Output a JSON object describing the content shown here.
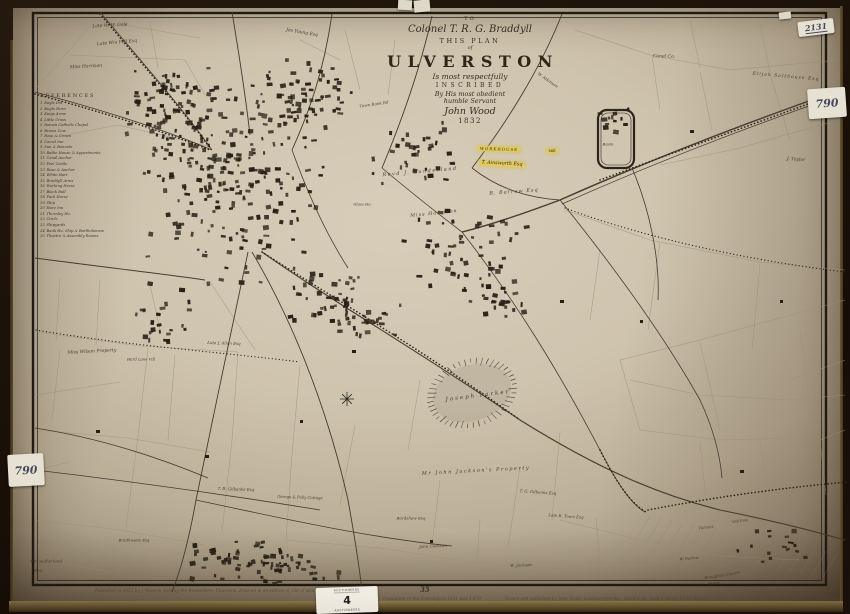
{
  "cartouche": {
    "to": "TO",
    "dedicatee": "Colonel T. R. G. Braddyll",
    "this_plan": "THIS PLAN",
    "of": "of",
    "town": "ULVERSTON",
    "respect_line": "Is most respectfully",
    "inscribed": "INSCRIBED",
    "obedient_line": "By His most obedient",
    "humble_line": "humble Servant",
    "signature": "John Wood",
    "year": "1832"
  },
  "references": {
    "heading": "REFERENCES",
    "items": [
      "Eagle Inn",
      "Bugle Horn",
      "Kings Arms",
      "Little Cross",
      "Roman Catholic Chapel",
      "Brown Cow",
      "Rose & Crown",
      "Camel Inn",
      "Sun & Bonnets",
      "Bathe House & Appartments",
      "Canal Anchor",
      "Peel Castle",
      "Rose & Anchor",
      "White Hart",
      "Braddyll Arms",
      "Working Horse",
      "Black Bull",
      "Pack Horse",
      "Ship",
      "Hare Inn",
      "Thornley Ho.",
      "Circle",
      "Shipyards",
      "Bank Ho. Ship & Bartholomew",
      "Theatre & Assembly Rooms"
    ]
  },
  "map_labels": [
    {
      "t": "Late W. W. Gale",
      "x": 110,
      "y": 26,
      "r": -3,
      "s": 4.5,
      "it": true
    },
    {
      "t": "Late Wm Fell Esq",
      "x": 117,
      "y": 43,
      "r": -5,
      "s": 4.5,
      "it": true
    },
    {
      "t": "Miss Harrison",
      "x": 86,
      "y": 67,
      "r": -3,
      "s": 4.5,
      "it": true
    },
    {
      "t": "Jas Young Esq",
      "x": 302,
      "y": 33,
      "r": 10,
      "s": 4.5,
      "it": true
    },
    {
      "t": "W. Atkinson",
      "x": 548,
      "y": 80,
      "r": 35,
      "s": 4,
      "it": true
    },
    {
      "t": "Town Bank Rd",
      "x": 374,
      "y": 104,
      "r": -8,
      "s": 4,
      "it": true
    },
    {
      "t": "Canal Co.",
      "x": 664,
      "y": 57,
      "r": 2,
      "s": 4.5,
      "it": true
    },
    {
      "t": "Elijah Salthouse Esq",
      "x": 786,
      "y": 77,
      "r": 5,
      "s": 4.5,
      "it": true,
      "sp": 1
    },
    {
      "t": "Basin",
      "x": 608,
      "y": 144,
      "r": 0,
      "s": 4,
      "it": true
    },
    {
      "t": "J. Taylor",
      "x": 796,
      "y": 160,
      "r": 4,
      "s": 4.5,
      "it": true
    },
    {
      "t": "WORKHOUSE",
      "x": 499,
      "y": 149,
      "r": 2,
      "s": 4,
      "sp": 1,
      "hl": true
    },
    {
      "t": "T. Ainsworth Esq",
      "x": 502,
      "y": 164,
      "r": 3,
      "s": 4.8,
      "it": true,
      "hl": true
    },
    {
      "t": "Mill",
      "x": 552,
      "y": 151,
      "r": 0,
      "s": 3.5,
      "hl": true
    },
    {
      "t": "Revd J. Sunderland",
      "x": 420,
      "y": 172,
      "r": -5,
      "s": 5,
      "it": true,
      "sp": 1.5
    },
    {
      "t": "Miss Harrison",
      "x": 434,
      "y": 214,
      "r": -6,
      "s": 4.8,
      "it": true,
      "sp": 1
    },
    {
      "t": "B. Barrow Esq",
      "x": 514,
      "y": 192,
      "r": -4,
      "s": 5,
      "it": true,
      "sp": 1
    },
    {
      "t": "Glass Ho",
      "x": 362,
      "y": 204,
      "r": 0,
      "s": 3.8,
      "it": true
    },
    {
      "t": "Joseph Parker",
      "x": 478,
      "y": 396,
      "r": -7,
      "s": 5.5,
      "it": true,
      "sp": 2
    },
    {
      "t": "Miss Wilson Property",
      "x": 92,
      "y": 352,
      "r": -3,
      "s": 4.5,
      "it": true
    },
    {
      "t": "Hard Lane Vill",
      "x": 141,
      "y": 359,
      "r": 0,
      "s": 3.8,
      "it": true
    },
    {
      "t": "Late J. Allan Esq",
      "x": 224,
      "y": 343,
      "r": 2,
      "s": 4,
      "it": true
    },
    {
      "t": "Mr John Jackson's Property",
      "x": 476,
      "y": 471,
      "r": -3,
      "s": 5,
      "it": true,
      "sp": 1.5
    },
    {
      "t": "T. G. Gilbanks Esq",
      "x": 538,
      "y": 492,
      "r": 4,
      "s": 4,
      "it": true
    },
    {
      "t": "Late R. Town Esq",
      "x": 566,
      "y": 516,
      "r": 4,
      "s": 4,
      "it": true
    },
    {
      "t": "Bardshaw Esq",
      "x": 411,
      "y": 518,
      "r": 0,
      "s": 4,
      "it": true
    },
    {
      "t": "John Cookson",
      "x": 433,
      "y": 546,
      "r": -3,
      "s": 4,
      "it": true
    },
    {
      "t": "W. Jackson",
      "x": 521,
      "y": 565,
      "r": -2,
      "s": 4,
      "it": true
    },
    {
      "t": "T. B. Gilbanks Esq",
      "x": 236,
      "y": 489,
      "r": 2,
      "s": 4,
      "it": true
    },
    {
      "t": "George & Polly Cottage",
      "x": 300,
      "y": 497,
      "r": 2,
      "s": 3.8,
      "it": true
    },
    {
      "t": "Braithwaite Esq",
      "x": 134,
      "y": 540,
      "r": 0,
      "s": 3.8,
      "it": true
    },
    {
      "t": "Wm Sutherland",
      "x": 46,
      "y": 561,
      "r": 0,
      "s": 4,
      "it": true
    },
    {
      "t": "Esq",
      "x": 38,
      "y": 570,
      "r": 0,
      "s": 4,
      "it": true
    },
    {
      "t": "Turners",
      "x": 706,
      "y": 527,
      "r": -6,
      "s": 3.8,
      "it": true
    },
    {
      "t": "Mill Dam",
      "x": 740,
      "y": 521,
      "r": -8,
      "s": 3.4,
      "it": true
    },
    {
      "t": "W. Barlow",
      "x": 689,
      "y": 558,
      "r": -5,
      "s": 3.8,
      "it": true
    },
    {
      "t": "Broughton Church",
      "x": 722,
      "y": 575,
      "r": -9,
      "s": 3.8,
      "it": true
    },
    {
      "t": "Propy",
      "x": 714,
      "y": 583,
      "r": -9,
      "s": 3.8,
      "it": true
    }
  ],
  "stickers": {
    "top_right_code": "2131",
    "right_price": "790",
    "left_price": "790",
    "lot": {
      "header": "AUCTIONEERS",
      "number": "4",
      "footer": "AUCTIONEERS"
    }
  },
  "imprint": {
    "published": "Published in 1832 by J. Wood & Sold by the Booksellers, Ulverston. Entered in an edition of 150 of which this is No.",
    "pencil_note": "35",
    "population": "Population of the Township in 1831 was 5,879",
    "drawn": "Drawn and published by John Wood, Landsurveyor &c., Edinburgh, from a survey by Mr Mason",
    "engraved": "Engraved by T. Murphy, Liverpool"
  },
  "colors": {
    "paper": "#cfc4ae",
    "ink": "#3b3429",
    "road": "#4a4132",
    "field_line": "#9a8e77",
    "building": "#261f16",
    "highlight": "#e2cc5c",
    "frame": "#1d130a",
    "gilt": "#6a5733",
    "sticker": "#e7e1d3"
  }
}
